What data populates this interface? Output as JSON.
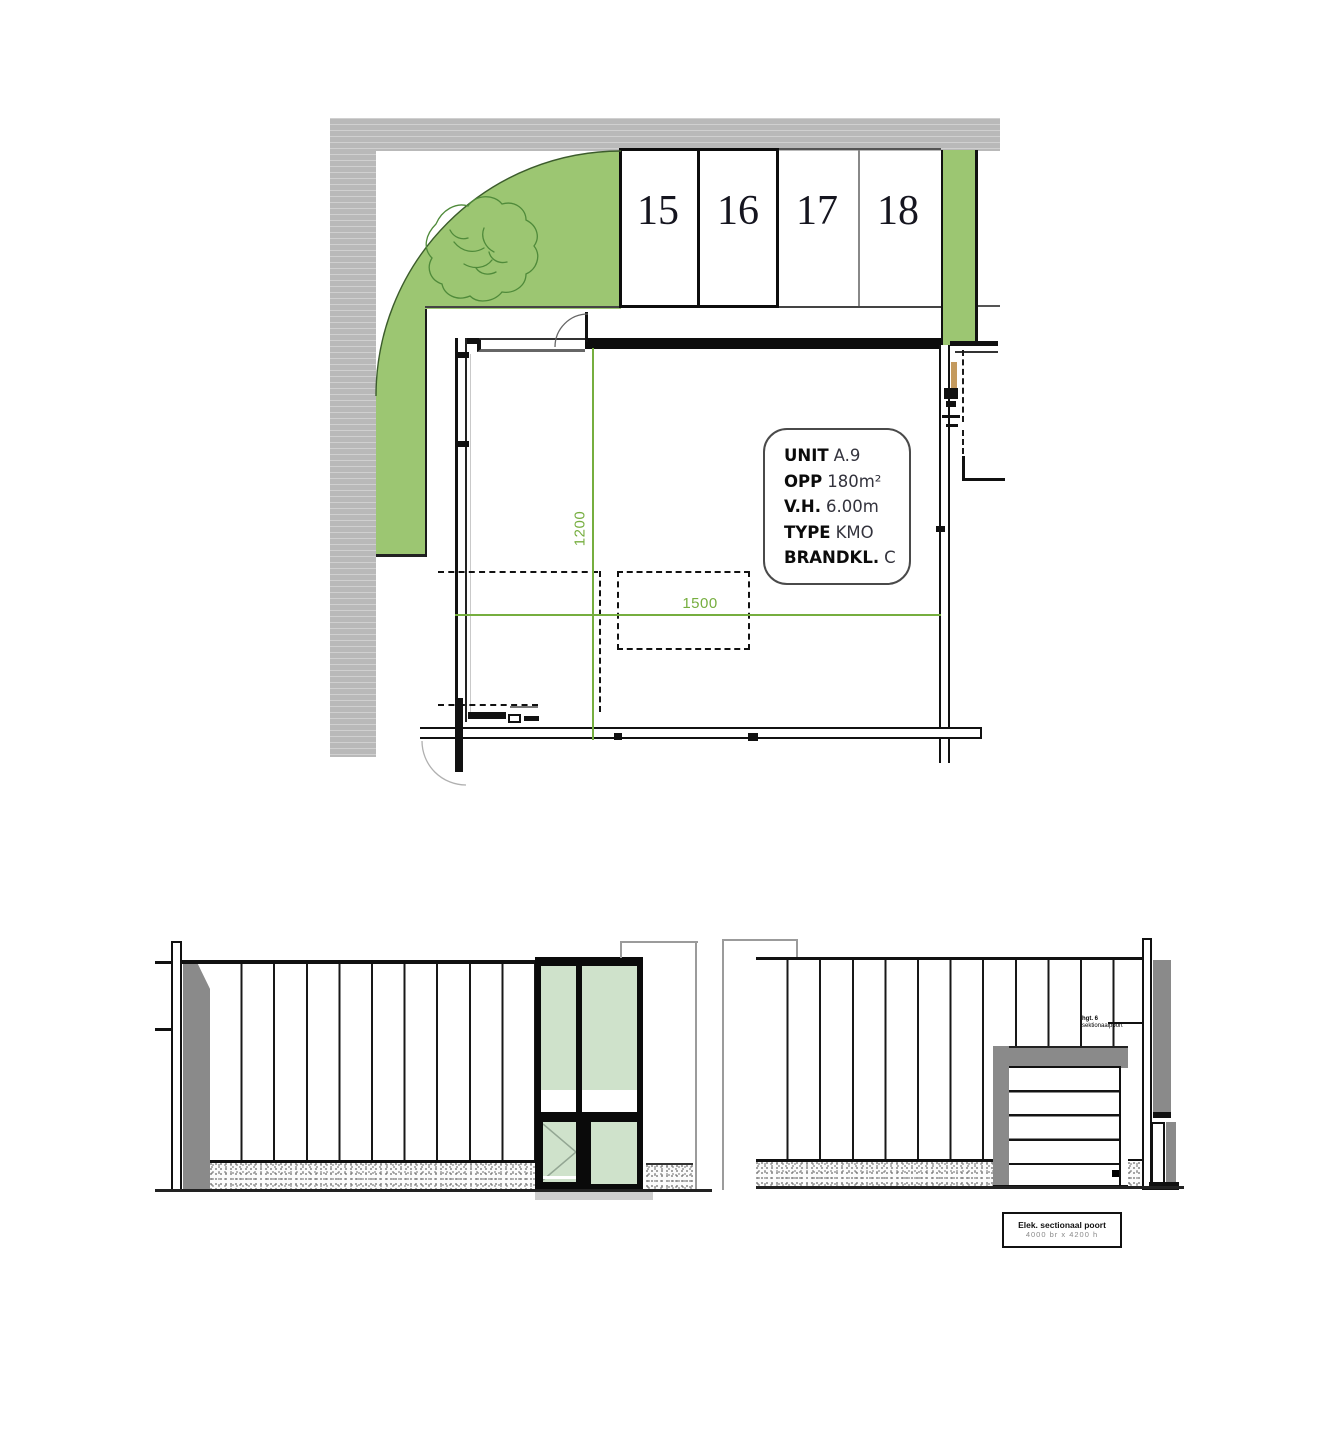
{
  "plan": {
    "parking": {
      "labels": [
        "15",
        "16",
        "17",
        "18"
      ]
    },
    "info_box": {
      "rows": [
        {
          "label": "UNIT",
          "value": "A.9"
        },
        {
          "label": "OPP",
          "value": "180m²"
        },
        {
          "label": "V.H.",
          "value": "6.00m"
        },
        {
          "label": "TYPE",
          "value": "KMO"
        },
        {
          "label": "BRANDKL.",
          "value": "C"
        }
      ]
    },
    "dimensions": {
      "vertical": "1200",
      "horizontal": "1500"
    }
  },
  "elevations": {
    "door_note": {
      "line1": "hgt. 6",
      "line2": "sektionaalpoort"
    },
    "door_label": {
      "line1": "Elek. sectionaal poort",
      "line2": "4000 br x 4200 h"
    }
  },
  "colors": {
    "landscape_green": "#9cc672",
    "dimension_green": "#76ae3f",
    "glass_green": "#cfe2cb",
    "road_gray": "#b9b9b9",
    "element_gray": "#8a8a8a",
    "wall_black": "#111111"
  }
}
